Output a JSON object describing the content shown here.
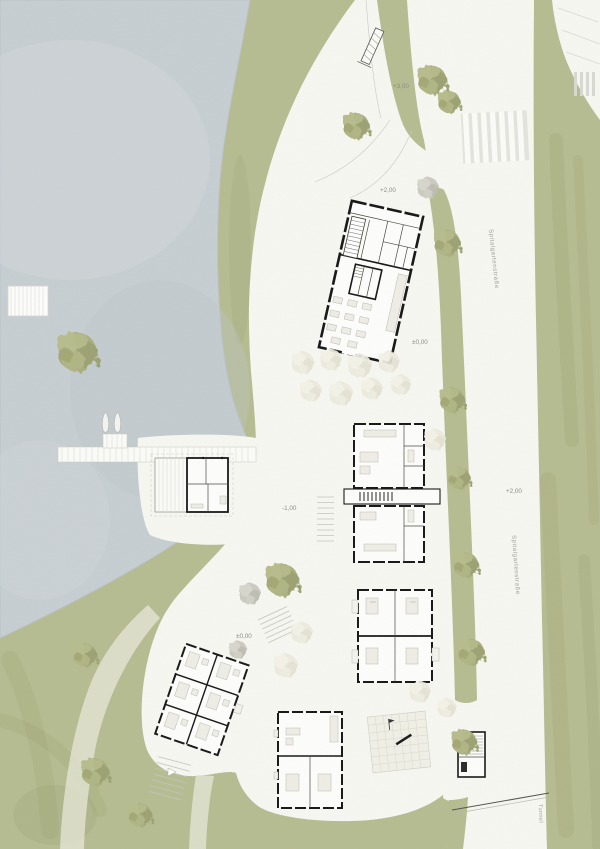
{
  "drawing": {
    "kind": "architectural site plan",
    "annotations": {
      "plus3": "+3,00",
      "plus2_top": "+2,00",
      "zero_main": "±0,00",
      "minus1": "-1,00",
      "zero_west": "±0,00",
      "plus2_road": "+2,00"
    },
    "streets": {
      "name_upper": "Spitalgartenstraße",
      "name_lower": "Spitalgartenstraße",
      "tunnel": "Tunnel"
    },
    "palette": {
      "paper_white": "#f7f7f2",
      "water": "#c6ced2",
      "green": "#b6bc90",
      "green_shade": "#8f9668",
      "wall_black": "#161616",
      "label_gray": "#8d8d86"
    }
  }
}
